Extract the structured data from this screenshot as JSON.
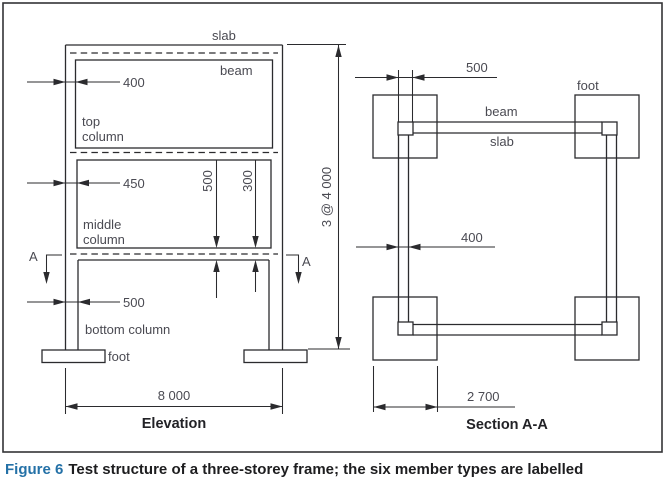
{
  "figure": {
    "caption_label": "Figure 6",
    "caption_text": "Test structure of a three-storey frame; the six member types are labelled"
  },
  "elevation": {
    "title": "Elevation",
    "section_marker": "A",
    "labels": {
      "slab": "slab",
      "beam": "beam",
      "top_column": [
        "top",
        "column"
      ],
      "middle_column": [
        "middle",
        "column"
      ],
      "bottom_column": "bottom column",
      "foot": "foot"
    },
    "dims": {
      "top_column_width": "400",
      "middle_column_width": "450",
      "bottom_column_width": "500",
      "beam_depth": "500",
      "slab_depth": "300",
      "total_height": "3 @ 4 000",
      "bay_width": "8 000"
    }
  },
  "section_aa": {
    "title": "Section A-A",
    "labels": {
      "beam": "beam",
      "slab": "slab",
      "foot": "foot"
    },
    "dims": {
      "corner_column_width": "500",
      "edge_beam_width": "400",
      "foot_width": "2 700"
    }
  }
}
